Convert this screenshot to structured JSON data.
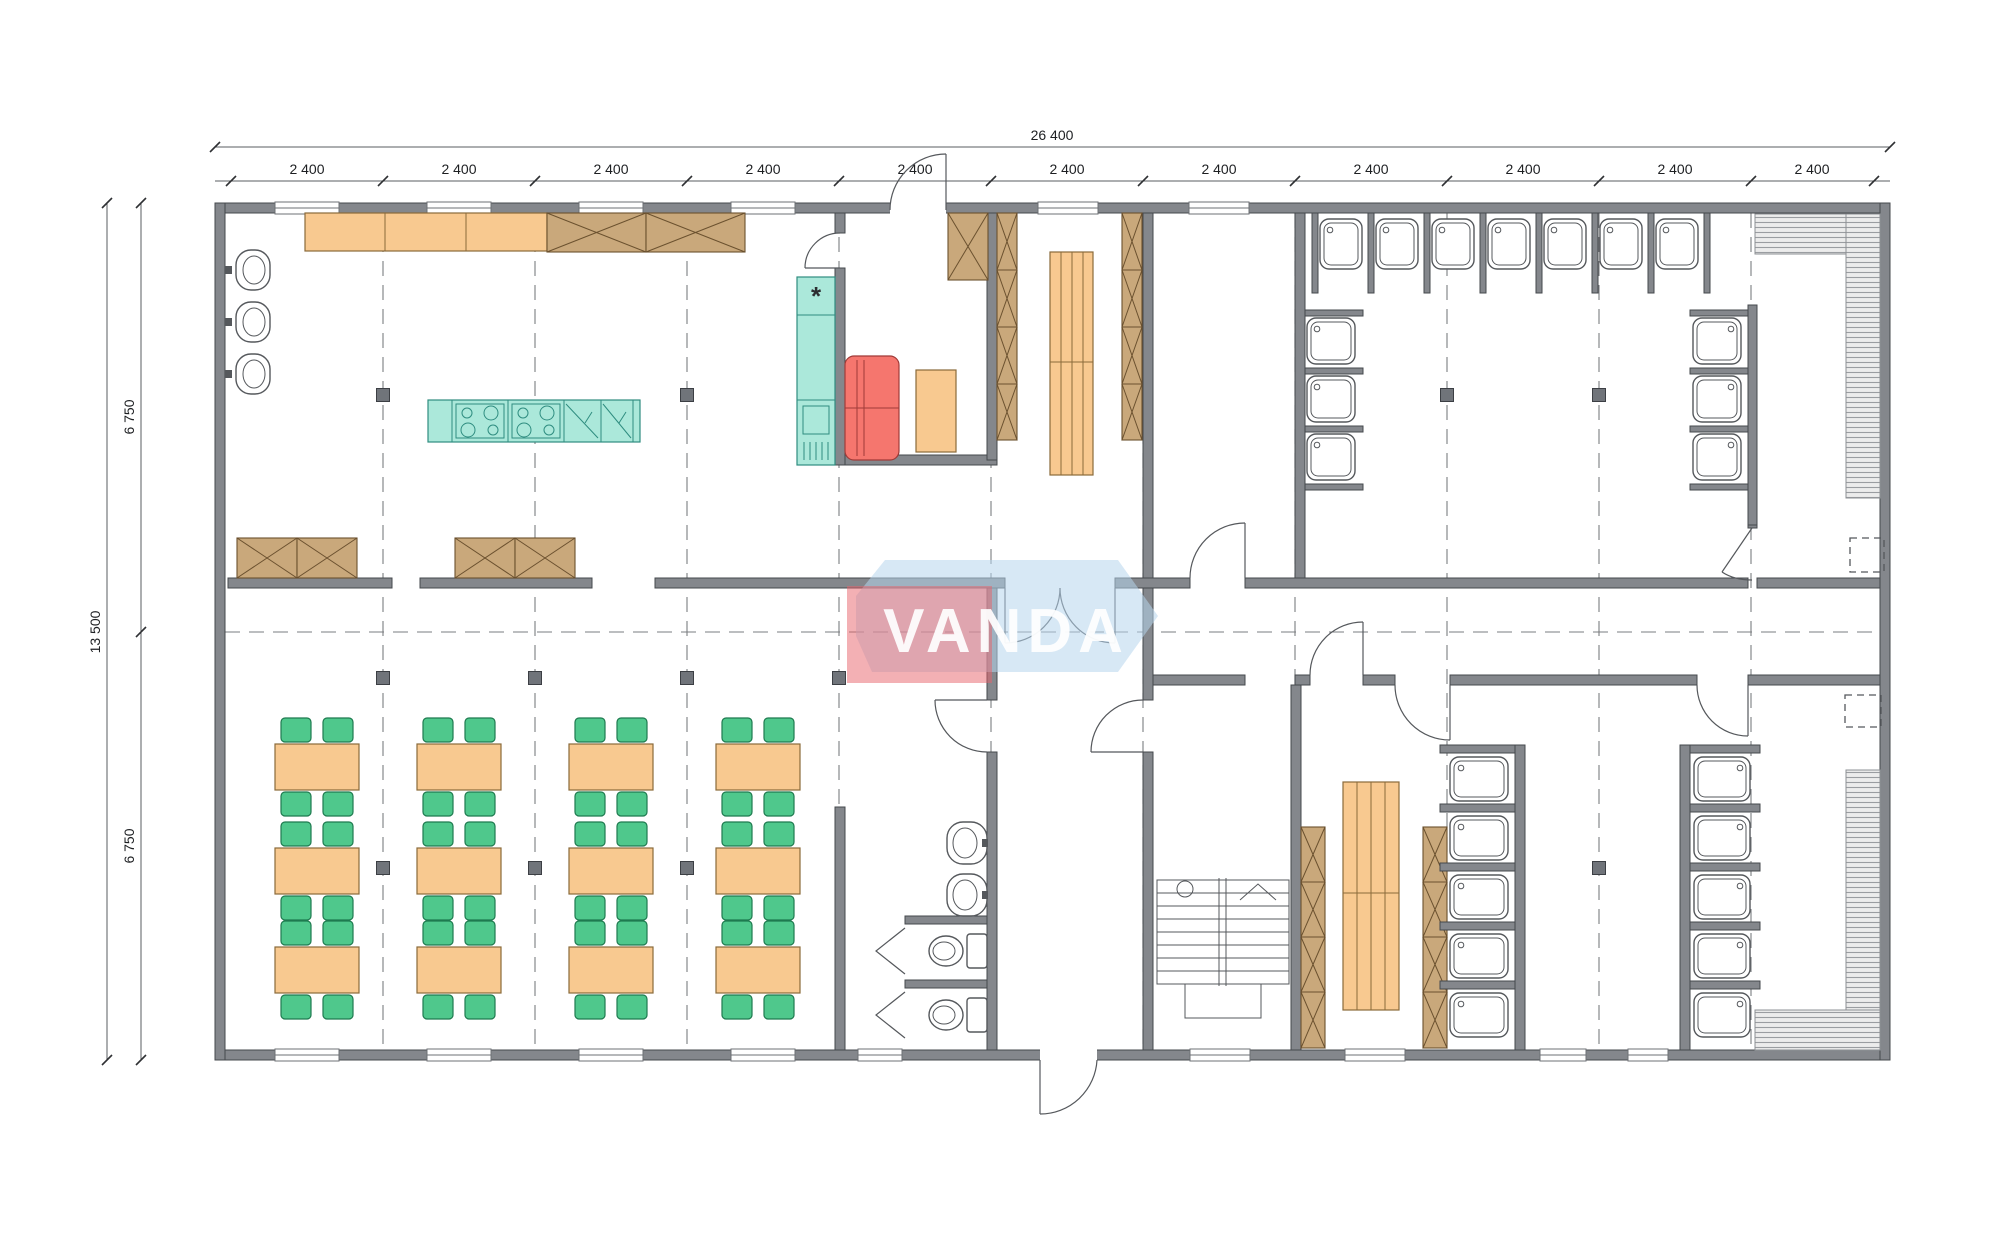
{
  "watermark": {
    "text": "VANDA",
    "red_color": "#e8616a",
    "blue_color": "#b7d6ec"
  },
  "dimensions": {
    "top_total": "26 400",
    "top_segments": [
      "2 400",
      "2 400",
      "2 400",
      "2 400",
      "2 400",
      "2 400",
      "2 400",
      "2 400",
      "2 400",
      "2 400",
      "2 400"
    ],
    "left_total": "13 500",
    "left_segments": [
      "6 750",
      "6 750"
    ]
  },
  "symbols": {
    "fridge": "*"
  },
  "colors": {
    "wall_gray": "#84878c",
    "counter_orange": "#f8c990",
    "cabinet_tan": "#c9a87b",
    "appliance_teal": "#abe8da",
    "sofa_red": "#f5766e",
    "chair_green": "#4fc88c"
  },
  "inventory": {
    "dining_tables": 12,
    "dining_chairs": 48,
    "kitchen_sinks": 3,
    "cooktops": 2,
    "dishwashers": 2,
    "refrigerators": 1,
    "counter_segments": 3,
    "crossed_storage_cabinets": 8,
    "locker_columns": 5,
    "tiered_benches": 2,
    "sofas": 1,
    "side_tables": 1,
    "shower_stalls": 23,
    "wash_basins": 2,
    "toilets": 2,
    "staircases": 1,
    "hatched_ramps": 2
  }
}
